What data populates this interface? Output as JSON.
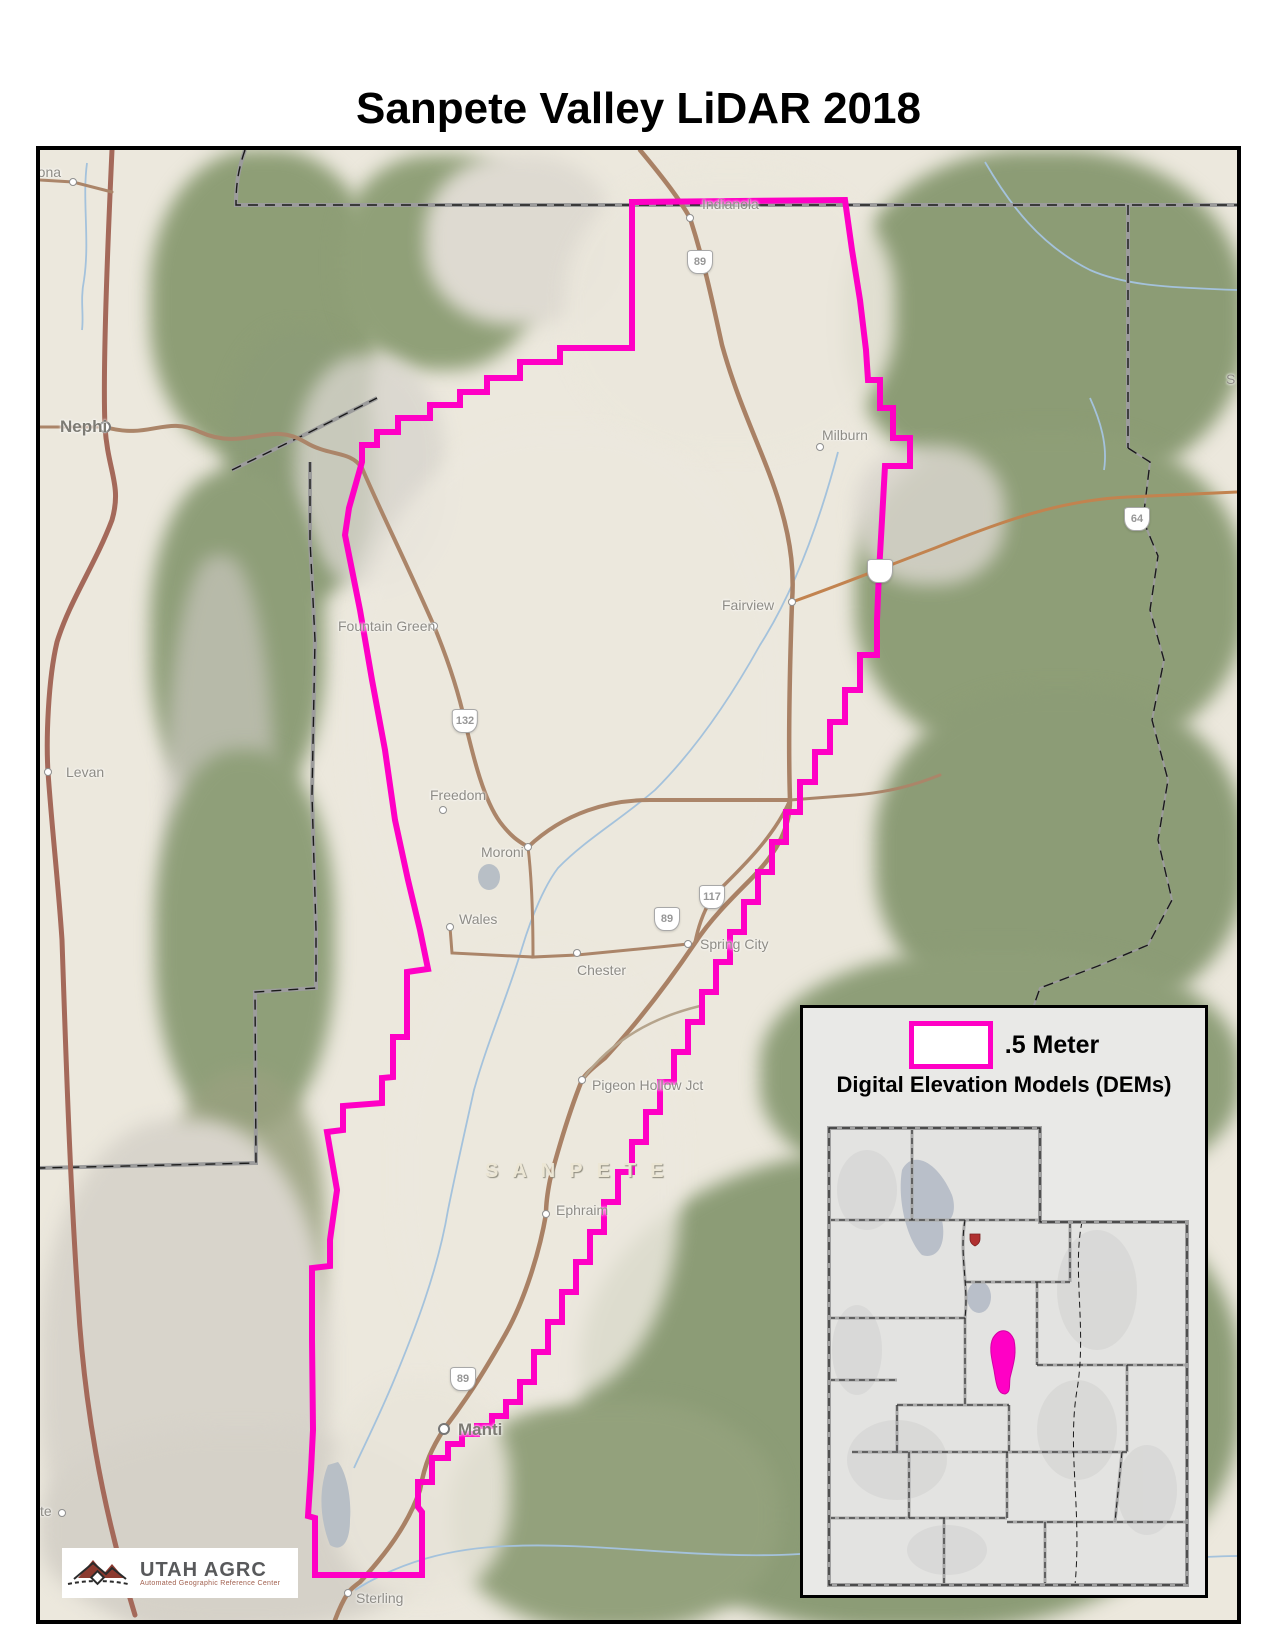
{
  "title": "Sanpete Valley LiDAR 2018",
  "legend": {
    "swatch_label": ".5 Meter",
    "subtitle": "Digital Elevation Models (DEMs)"
  },
  "logo": {
    "title": "UTAH AGRC",
    "subtitle": "Automated Geographic Reference Center"
  },
  "colors": {
    "lidar_boundary": "#ff00c5",
    "highway_brown": "#a98165",
    "canyon_road_orange": "#c2834f",
    "county_line_gray": "#9c9c9c",
    "water_blue": "#a4c2dc",
    "legend_background": "#e9e9e7"
  },
  "map": {
    "county_label": {
      "text": "SANPETE"
    },
    "towns": [
      {
        "name": "Mona",
        "lx": 26,
        "ly": 164,
        "dx": 73,
        "dy": 182
      },
      {
        "name": "Nephi",
        "lx": 60,
        "ly": 417,
        "dx": 105,
        "dy": 427,
        "major": true
      },
      {
        "name": "Levan",
        "lx": 66,
        "ly": 764,
        "dx": 48,
        "dy": 772
      },
      {
        "name": "Fayette",
        "lx": 5,
        "ly": 1503,
        "dx": 62,
        "dy": 1513
      },
      {
        "name": "Indianola",
        "lx": 702,
        "ly": 196,
        "dx": 690,
        "dy": 218
      },
      {
        "name": "Milburn",
        "lx": 822,
        "ly": 427,
        "dx": 820,
        "dy": 447
      },
      {
        "name": "Fairview",
        "lx": 722,
        "ly": 597,
        "dx": 792,
        "dy": 602
      },
      {
        "name": "Fountain Green",
        "lx": 338,
        "ly": 618,
        "dx": 434,
        "dy": 626
      },
      {
        "name": "Freedom",
        "lx": 430,
        "ly": 787,
        "dx": 443,
        "dy": 810
      },
      {
        "name": "Moroni",
        "lx": 481,
        "ly": 844,
        "dx": 528,
        "dy": 847
      },
      {
        "name": "Wales",
        "lx": 459,
        "ly": 911,
        "dx": 450,
        "dy": 927
      },
      {
        "name": "Chester",
        "lx": 577,
        "ly": 962,
        "dx": 577,
        "dy": 953
      },
      {
        "name": "Spring City",
        "lx": 700,
        "ly": 936,
        "dx": 688,
        "dy": 944
      },
      {
        "name": "Pigeon Hollow Jct",
        "lx": 592,
        "ly": 1077,
        "dx": 582,
        "dy": 1080
      },
      {
        "name": "Ephraim",
        "lx": 556,
        "ly": 1202,
        "dx": 546,
        "dy": 1214
      },
      {
        "name": "Manti",
        "lx": 458,
        "ly": 1420,
        "dx": 444,
        "dy": 1429,
        "major": true
      },
      {
        "name": "Sterling",
        "lx": 356,
        "ly": 1590,
        "dx": 348,
        "dy": 1593
      }
    ],
    "partial_labels": [
      {
        "text": "S",
        "x": 1226,
        "y": 371
      }
    ],
    "route_shields": [
      {
        "label": "89",
        "x": 700,
        "y": 262,
        "type": "us"
      },
      {
        "label": "89",
        "x": 667,
        "y": 919,
        "type": "us"
      },
      {
        "label": "89",
        "x": 463,
        "y": 1379,
        "type": "us"
      },
      {
        "label": "132",
        "x": 465,
        "y": 721,
        "type": "state"
      },
      {
        "label": "117",
        "x": 712,
        "y": 897,
        "type": "state"
      },
      {
        "label": "64",
        "x": 1137,
        "y": 519,
        "type": "state"
      },
      {
        "label": "",
        "x": 880,
        "y": 571,
        "type": "state"
      }
    ]
  }
}
